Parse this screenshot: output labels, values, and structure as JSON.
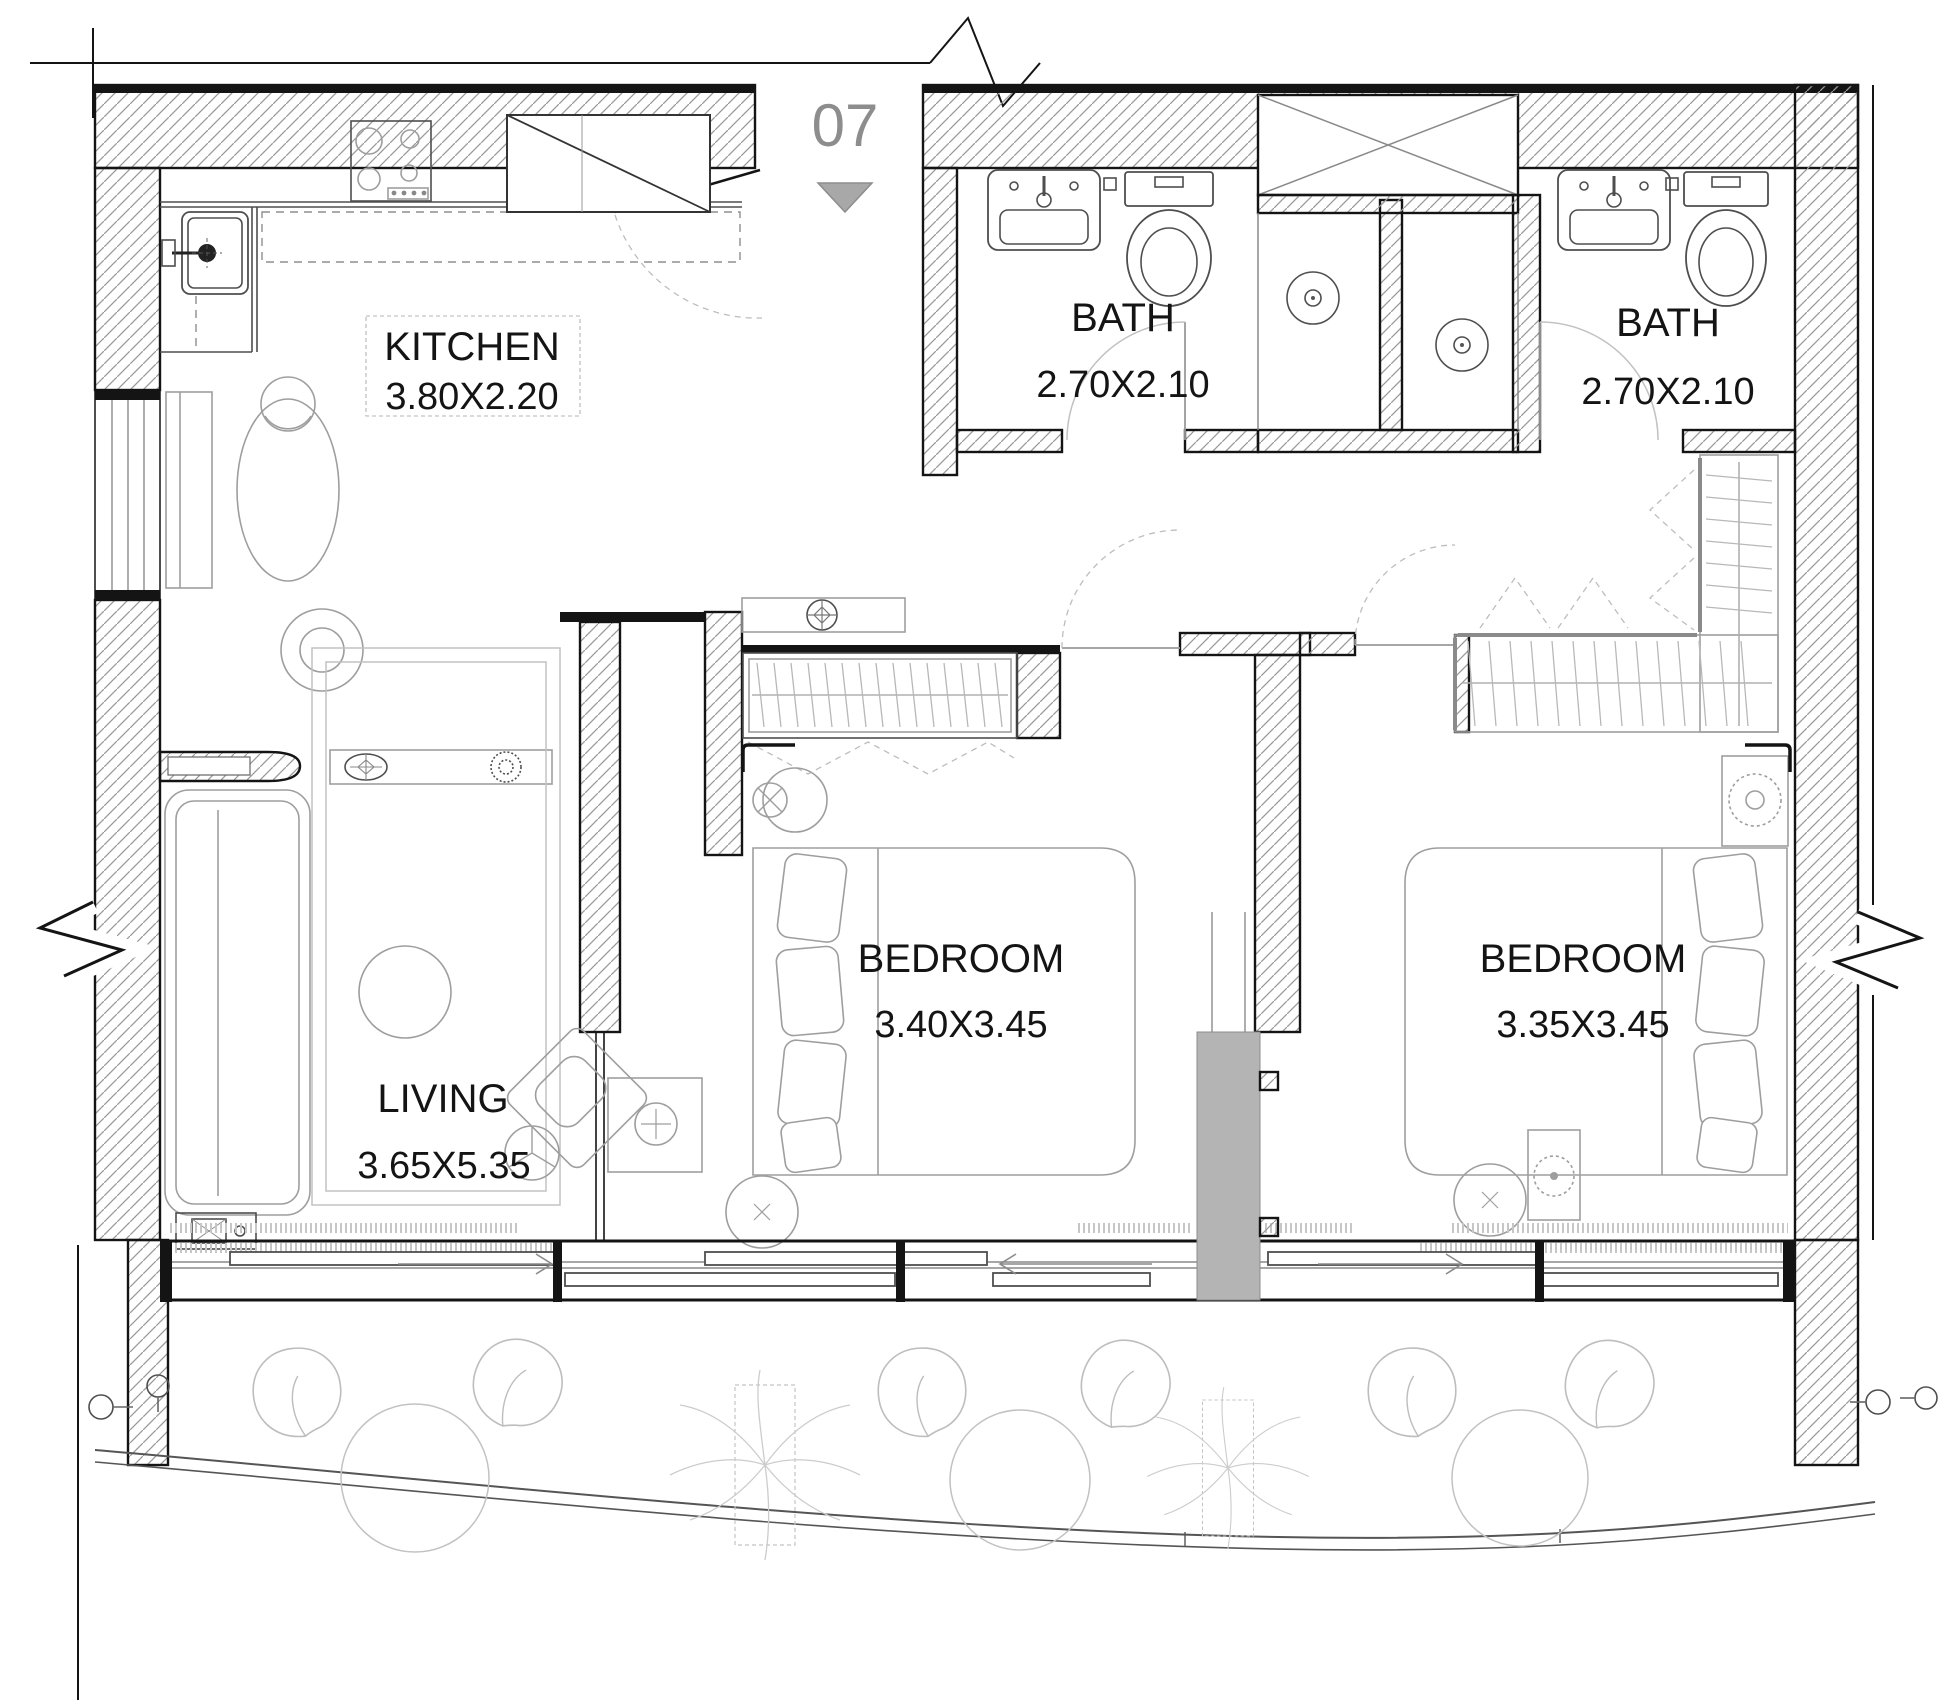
{
  "drawing": {
    "type": "apartment-floor-plan",
    "unit": {
      "number": "07"
    },
    "rooms": [
      {
        "id": "kitchen",
        "name": "KITCHEN",
        "dims": "3.80X2.20"
      },
      {
        "id": "bath-1",
        "name": "BATH",
        "dims": "2.70X2.10"
      },
      {
        "id": "bath-2",
        "name": "BATH",
        "dims": "2.70X2.10"
      },
      {
        "id": "bedroom-1",
        "name": "BEDROOM",
        "dims": "3.40X3.45"
      },
      {
        "id": "bedroom-2",
        "name": "BEDROOM",
        "dims": "3.35X3.45"
      },
      {
        "id": "living",
        "name": "LIVING",
        "dims": "3.65X5.35"
      }
    ],
    "colors": {
      "wall_line": "#141414",
      "hatch": "#9a9a9a",
      "furniture": "#9e9e9e",
      "fixture": "#4e4e4e",
      "label": "#141414",
      "unit_label": "#8d8d8d",
      "entry_marker": "#a8a8a8",
      "column_fill": "#b4b4b4",
      "background": "#ffffff"
    }
  }
}
